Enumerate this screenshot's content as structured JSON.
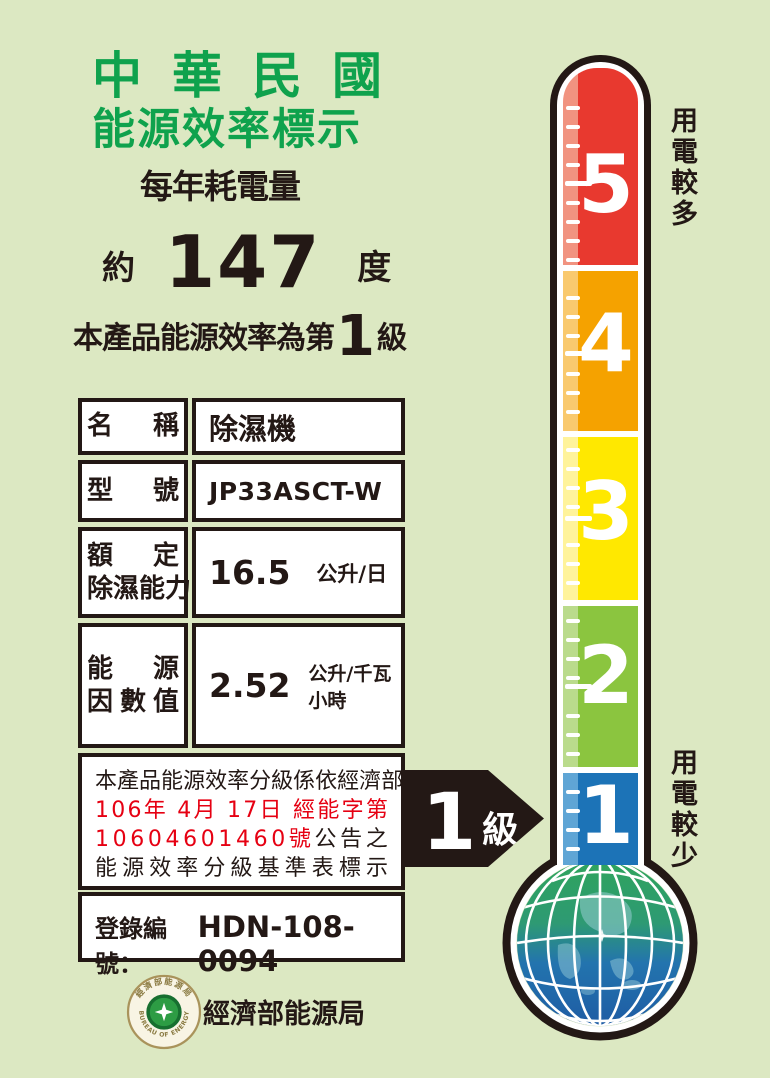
{
  "label": {
    "title_line1": "中華民國",
    "title_line2": "能源效率標示",
    "subtitle": "每年耗電量",
    "approx": "約",
    "consumption_value": "147",
    "consumption_unit": "度",
    "grade_prefix": "本產品能源效率為第",
    "grade": "1",
    "grade_suffix": "級"
  },
  "table": {
    "rows": [
      {
        "label_lines": [
          "名稱"
        ],
        "value": "除濕機"
      },
      {
        "label_lines": [
          "型號"
        ],
        "value": "JP33ASCT-W"
      },
      {
        "label_lines": [
          "額定",
          "除濕能力"
        ],
        "value": "16.5",
        "unit": "公升/日"
      },
      {
        "label_lines": [
          "能源",
          "因數值"
        ],
        "value": "2.52",
        "unit": "公升/千瓦小時"
      }
    ]
  },
  "notice": {
    "lines": [
      [
        {
          "text": "本產品能源效率分級係依經濟部",
          "color": "#231815"
        }
      ],
      [
        {
          "text": "106年 4月 17日 經能字第",
          "color": "#E60012"
        }
      ],
      [
        {
          "text": "10604601460號",
          "color": "#E60012"
        },
        {
          "text": "公告之",
          "color": "#231815"
        }
      ],
      [
        {
          "text": "能源效率分級基準表標示",
          "color": "#231815"
        }
      ]
    ]
  },
  "registration": {
    "label": "登錄編號：",
    "value": "HDN-108-0094"
  },
  "agency": {
    "name": "經濟部能源局",
    "badge_top": "經濟部能源局",
    "badge_bottom": "BUREAU OF ENERGY"
  },
  "thermometer": {
    "top_label": "用電較多",
    "bottom_label": "用電較少",
    "levels": [
      {
        "num": "5",
        "color": "#E8392F",
        "light": "#F19380"
      },
      {
        "num": "4",
        "color": "#F5A200",
        "light": "#F9C96E"
      },
      {
        "num": "3",
        "color": "#FFE800",
        "light": "#FFF39B"
      },
      {
        "num": "2",
        "color": "#8BC53F",
        "light": "#BADB8C"
      },
      {
        "num": "1",
        "color": "#1C73B7",
        "light": "#5FA5D5"
      }
    ]
  },
  "arrow": {
    "grade": "1",
    "suffix": "級"
  },
  "colors": {
    "background": "#DCE8C2",
    "ink": "#231815",
    "title_green": "#0FA24D",
    "notice_red": "#E60012"
  }
}
